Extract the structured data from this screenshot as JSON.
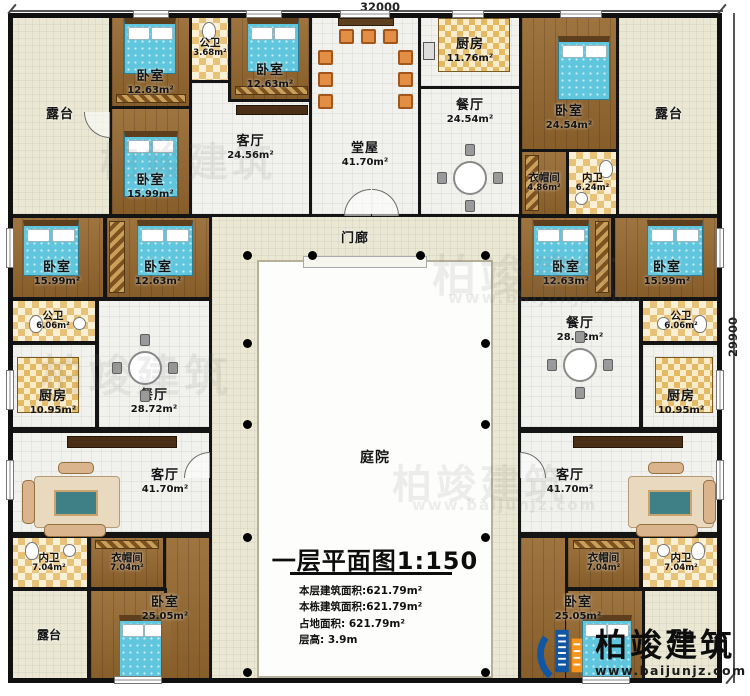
{
  "dimensions": {
    "width": "32000",
    "height": "29900"
  },
  "watermark": {
    "text": "柏竣建筑",
    "url": "www.baijunjz.com"
  },
  "logo": {
    "name": "柏竣建筑",
    "url": "www.baijunjz.com"
  },
  "title_block": {
    "title": "一层平面图",
    "scale": "1:150",
    "stats": {
      "line1": "本层建筑面积:621.79m²",
      "line2": "本栋建筑面积:621.79m²",
      "line3": "占地面积: 621.79m²",
      "line4": "层高: 3.9m"
    }
  },
  "colors": {
    "wall": "#141414",
    "wood_floor": "#96682f",
    "tile_floor": "#f1f1ee",
    "terrace_floor": "#eae8d3",
    "bath_checker": "#e9c279",
    "bed_blue": "#5fc6dd",
    "logo_blue": "#1156a3",
    "logo_orange": "#f7941d"
  },
  "rooms": {
    "terrace_tl": {
      "name": "露台"
    },
    "terrace_tr": {
      "name": "露台"
    },
    "terrace_bl": {
      "name": "露台"
    },
    "terrace_br": {
      "name": "露台"
    },
    "bedroom_tl1": {
      "name": "卧室",
      "area": "12.63m²"
    },
    "bedroom_tl2": {
      "name": "卧室",
      "area": "12.63m²"
    },
    "bedroom_tl3": {
      "name": "卧室",
      "area": "15.99m²"
    },
    "bath_top": {
      "name": "公卫",
      "area": "3.68m²"
    },
    "living_tl": {
      "name": "客厅",
      "area": "24.56m²"
    },
    "hall_top": {
      "name": "堂屋",
      "area": "41.70m²"
    },
    "kitchen_top": {
      "name": "厨房",
      "area": "11.76m²"
    },
    "dining_top": {
      "name": "餐厅",
      "area": "24.54m²"
    },
    "bedroom_tr": {
      "name": "卧室",
      "area": "24.54m²"
    },
    "closet_tr": {
      "name": "衣帽间",
      "area": "4.86m²"
    },
    "bath_tr": {
      "name": "内卫",
      "area": "6.24m²"
    },
    "porch": {
      "name": "门廊"
    },
    "bedroom_ml1": {
      "name": "卧室",
      "area": "15.99m²"
    },
    "bedroom_ml2": {
      "name": "卧室",
      "area": "12.63m²"
    },
    "bath_ml": {
      "name": "公卫",
      "area": "6.06m²"
    },
    "kitchen_ml": {
      "name": "厨房",
      "area": "10.95m²"
    },
    "dining_ml": {
      "name": "餐厅",
      "area": "28.72m²"
    },
    "bedroom_mr1": {
      "name": "卧室",
      "area": "12.63m²"
    },
    "bedroom_mr2": {
      "name": "卧室",
      "area": "15.99m²"
    },
    "dining_mr": {
      "name": "餐厅",
      "area": "28.72m²"
    },
    "bath_mr": {
      "name": "公卫",
      "area": "6.06m²"
    },
    "kitchen_mr": {
      "name": "厨房",
      "area": "10.95m²"
    },
    "courtyard": {
      "name": "庭院"
    },
    "living_bl": {
      "name": "客厅",
      "area": "41.70m²"
    },
    "bath_bl": {
      "name": "内卫",
      "area": "7.04m²"
    },
    "closet_bl": {
      "name": "衣帽间",
      "area": "7.04m²"
    },
    "bedroom_bl": {
      "name": "卧室",
      "area": "25.05m²"
    },
    "living_br": {
      "name": "客厅",
      "area": "41.70m²"
    },
    "closet_br": {
      "name": "衣帽间",
      "area": "7.04m²"
    },
    "bath_br": {
      "name": "内卫",
      "area": "7.04m²"
    },
    "bedroom_br": {
      "name": "卧室",
      "area": "25.05m²"
    }
  }
}
